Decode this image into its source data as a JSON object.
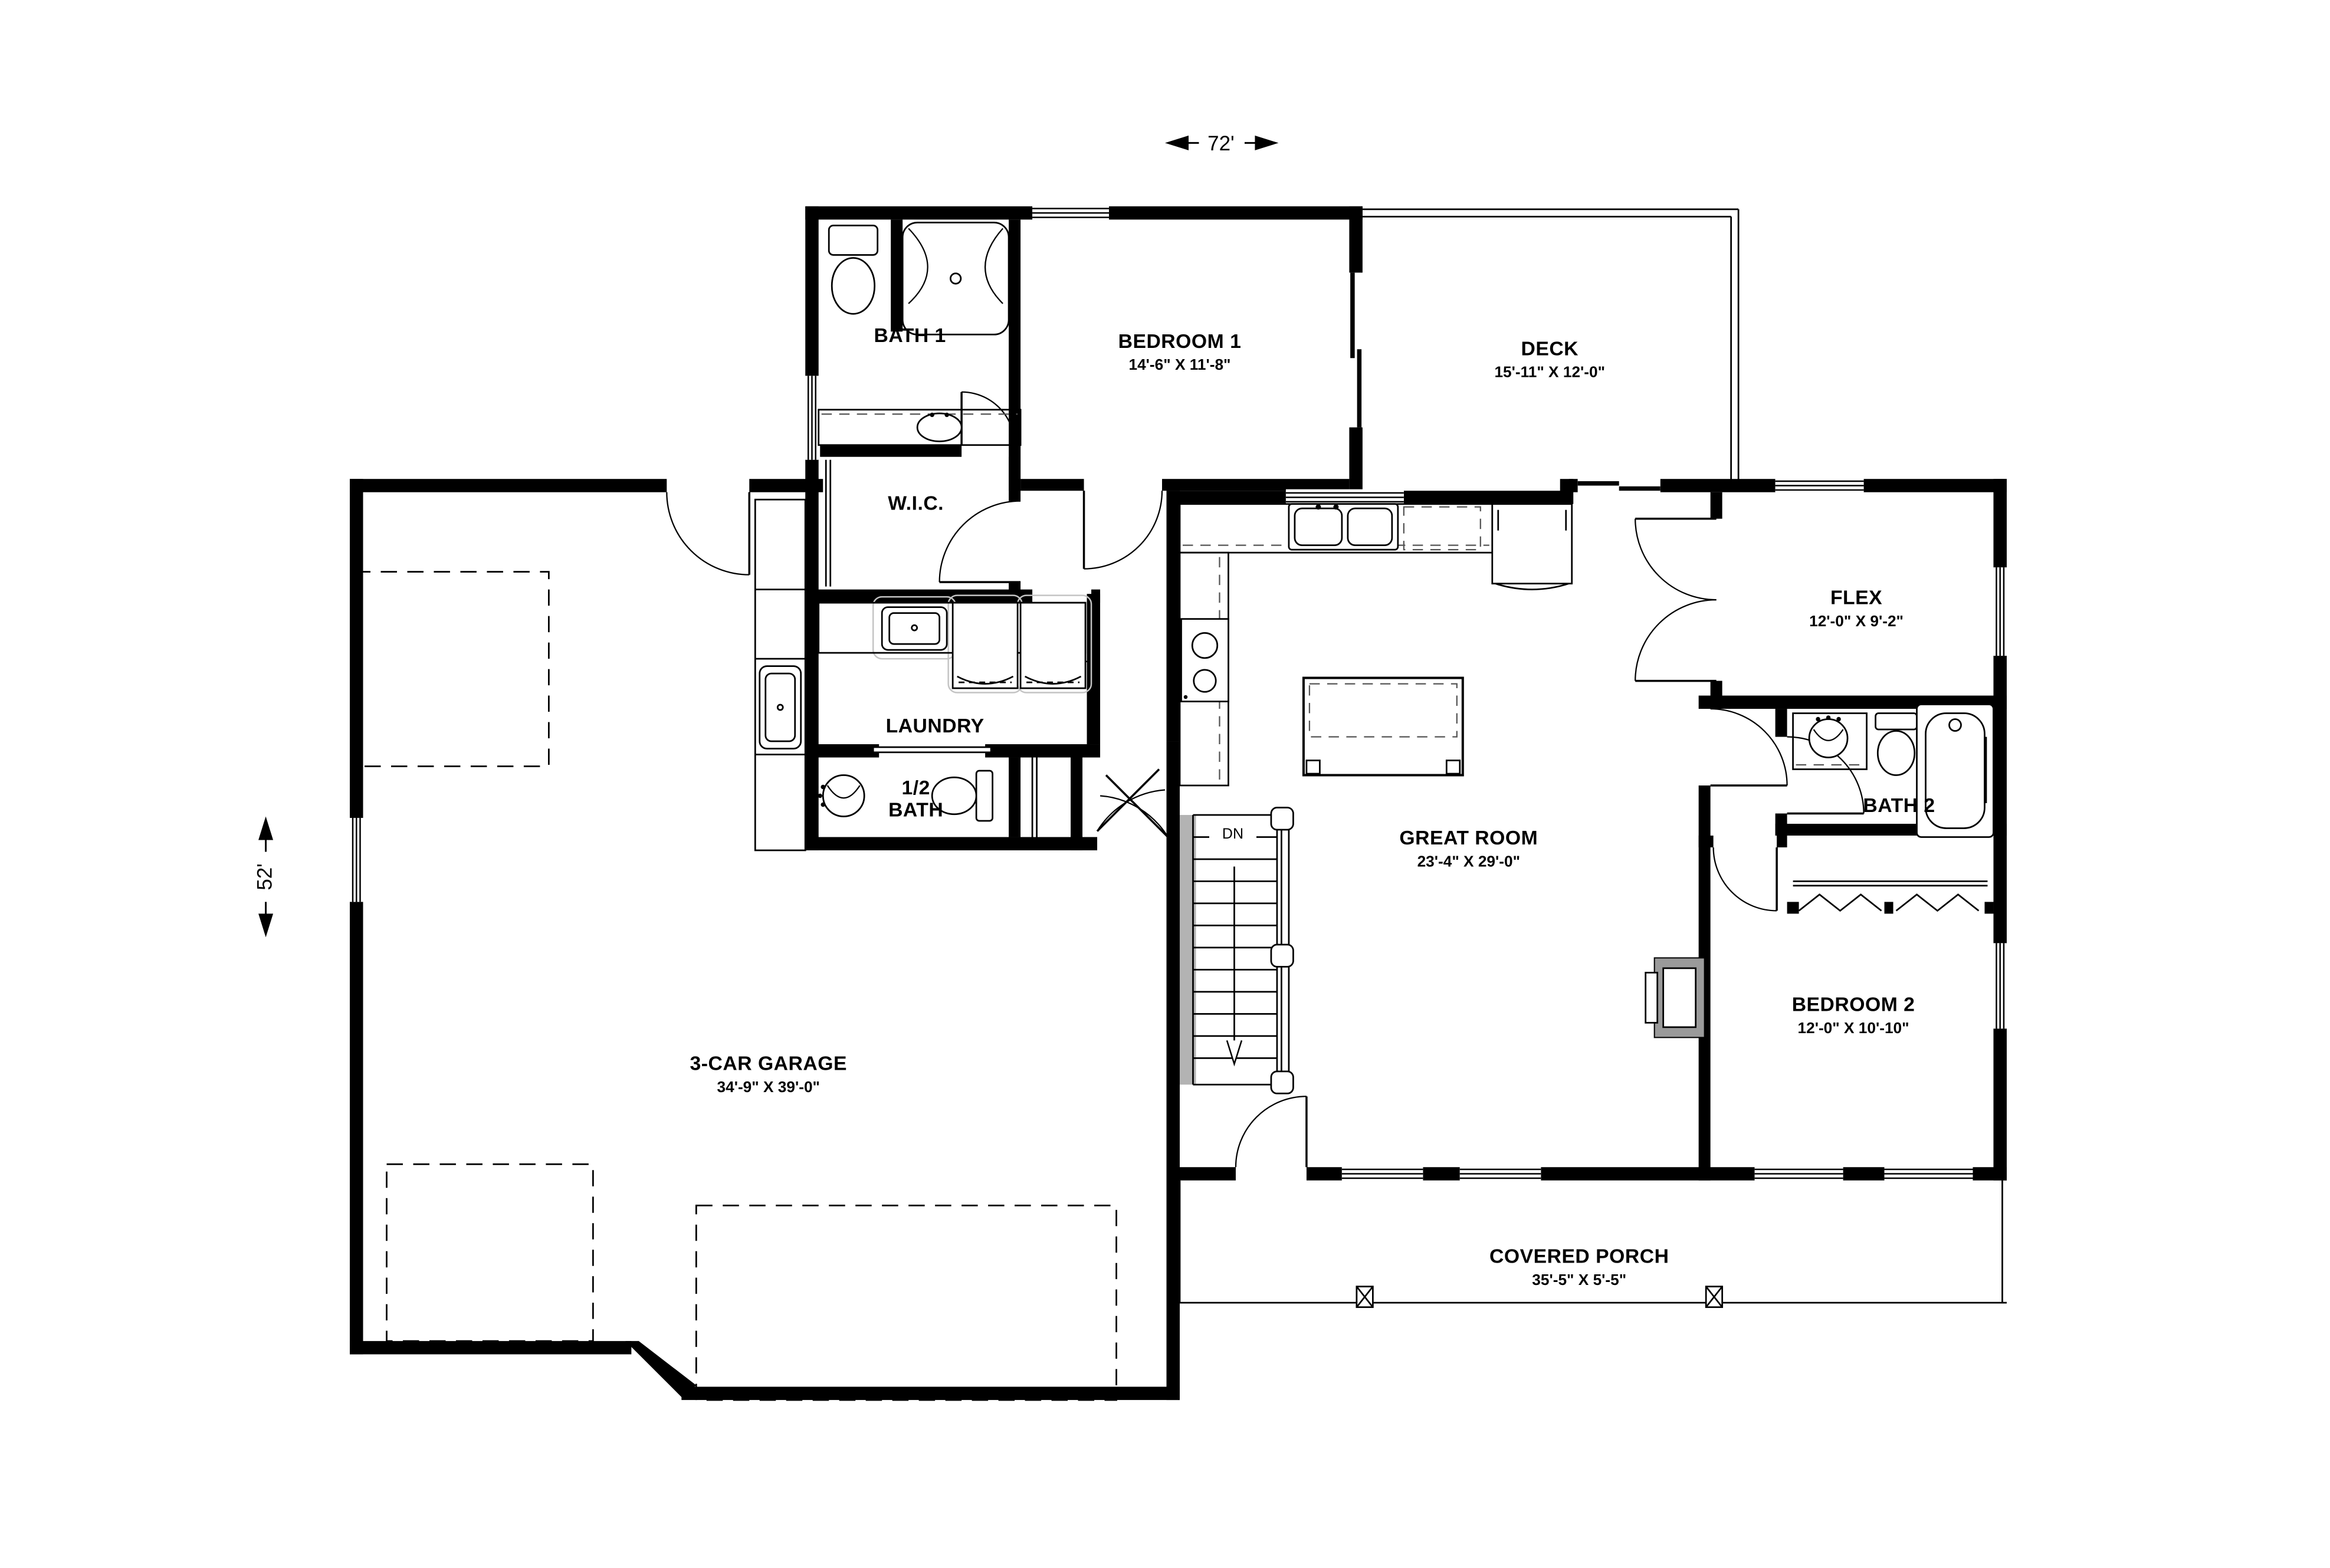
{
  "dimensions": {
    "overall_width": "72'",
    "overall_height": "52'"
  },
  "rooms": {
    "bath1": {
      "name": "BATH 1"
    },
    "bedroom1": {
      "name": "BEDROOM 1",
      "dims": "14'-6\" X 11'-8\""
    },
    "deck": {
      "name": "DECK",
      "dims": "15'-11\" X 12'-0\""
    },
    "wic": {
      "name": "W.I.C."
    },
    "laundry": {
      "name": "LAUNDRY"
    },
    "half_bath": {
      "line1": "1/2",
      "line2": "BATH"
    },
    "flex": {
      "name": "FLEX",
      "dims": "12'-0\" X 9'-2\""
    },
    "bath2": {
      "name": "BATH 2"
    },
    "great_room": {
      "name": "GREAT ROOM",
      "dims": "23'-4\" X 29'-0\""
    },
    "bedroom2": {
      "name": "BEDROOM 2",
      "dims": "12'-0\" X 10'-10\""
    },
    "garage": {
      "name": "3-CAR GARAGE",
      "dims": "34'-9\" X 39'-0\""
    },
    "covered_porch": {
      "name": "COVERED PORCH",
      "dims": "35'-5\" X 5'-5\""
    }
  },
  "stairs": {
    "direction_label": "DN"
  },
  "colors": {
    "walls": "#000000",
    "background": "#ffffff",
    "fireplace_shading": "#9a9a9a",
    "stair_wall_shading": "#b3b3b3",
    "appliance_ghost_outline": "#c4c4c4"
  }
}
